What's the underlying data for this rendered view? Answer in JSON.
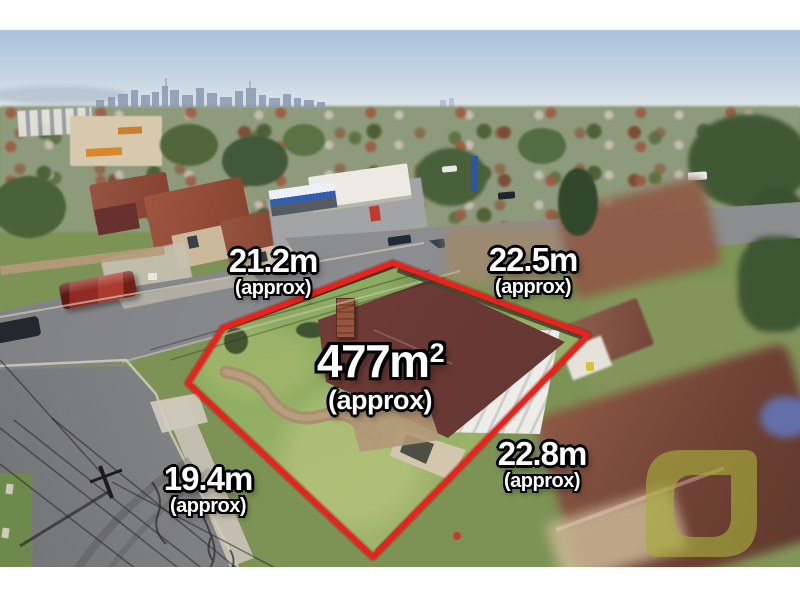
{
  "annotations": {
    "area_label": {
      "value": "477m",
      "superscript": "2",
      "qualifier": "(approx)"
    },
    "boundary_labels": [
      {
        "side": "north-west",
        "value": "21.2m",
        "qualifier": "(approx)"
      },
      {
        "side": "north-east",
        "value": "22.5m",
        "qualifier": "(approx)"
      },
      {
        "side": "south-east",
        "value": "22.8m",
        "qualifier": "(approx)"
      },
      {
        "side": "south-west",
        "value": "19.4m",
        "qualifier": "(approx)"
      }
    ],
    "colors": {
      "boundary_outline": "#e8231e",
      "label_text": "#ffffff",
      "label_outline": "#000000",
      "watermark": "#a6aa3d"
    }
  }
}
